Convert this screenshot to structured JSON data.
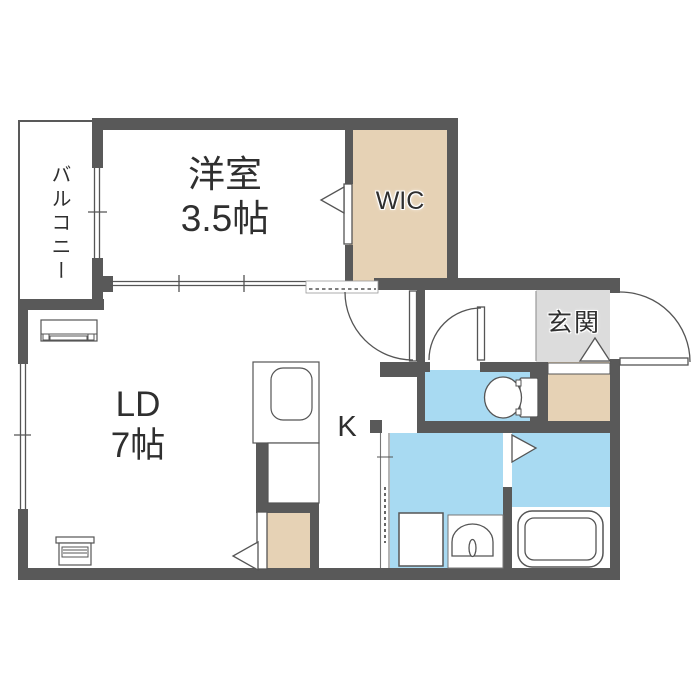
{
  "floorplan": {
    "rooms": {
      "balcony": {
        "label": "バルコニー"
      },
      "western_room": {
        "label": "洋室",
        "size": "3.5帖"
      },
      "wic": {
        "label": "WIC"
      },
      "living_dining": {
        "label": "LD",
        "size": "7帖"
      },
      "kitchen": {
        "label": "K"
      },
      "entrance": {
        "label": "玄関"
      }
    },
    "colors": {
      "wall": "#595959",
      "closet": "#e6d2b5",
      "water_area": "#a8daf2",
      "entrance_floor": "#dcdcdc",
      "fixture_outline": "#555555",
      "label_text": "#2f2f2f"
    }
  }
}
